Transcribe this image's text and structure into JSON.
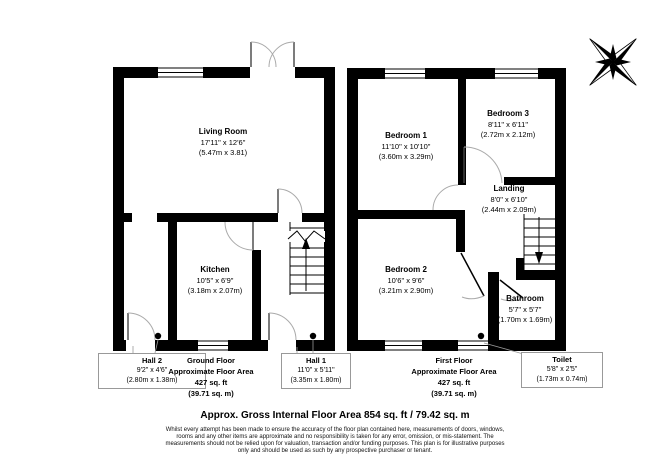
{
  "colors": {
    "wall": "#000000",
    "door_arc": "#aaaaaa",
    "door_leaf": "#444444",
    "label_box_border": "#999999",
    "text": "#000000"
  },
  "icons": {
    "compass": "compass-rose"
  },
  "ground_floor": {
    "title": "Ground Floor",
    "subtitle": "Approximate Floor Area",
    "area_ft": "427 sq. ft",
    "area_m": "(39.71 sq. m)",
    "rooms": {
      "living_room": {
        "name": "Living Room",
        "imperial": "17'11\" x 12'6\"",
        "metric": "(5.47m x 3.81)"
      },
      "kitchen": {
        "name": "Kitchen",
        "imperial": "10'5\" x 6'9\"",
        "metric": "(3.18m x 2.07m)"
      },
      "hall2": {
        "name": "Hall 2",
        "imperial": "9'2\" x 4'6\"",
        "metric": "(2.80m x 1.38m)"
      },
      "hall1": {
        "name": "Hall 1",
        "imperial": "11'0\" x 5'11\"",
        "metric": "(3.35m x 1.80m)"
      }
    }
  },
  "first_floor": {
    "title": "First Floor",
    "subtitle": "Approximate Floor Area",
    "area_ft": "427 sq. ft",
    "area_m": "(39.71 sq. m)",
    "rooms": {
      "bedroom1": {
        "name": "Bedroom 1",
        "imperial": "11'10\" x 10'10\"",
        "metric": "(3.60m x 3.29m)"
      },
      "bedroom2": {
        "name": "Bedroom 2",
        "imperial": "10'6\" x 9'6\"",
        "metric": "(3.21m x 2.90m)"
      },
      "bedroom3": {
        "name": "Bedroom 3",
        "imperial": "8'11\" x 6'11\"",
        "metric": "(2.72m x 2.12m)"
      },
      "landing": {
        "name": "Landing",
        "imperial": "8'0\" x 6'10\"",
        "metric": "(2.44m x 2.09m)"
      },
      "bathroom": {
        "name": "Bathroom",
        "imperial": "5'7\" x 5'7\"",
        "metric": "(1.70m x 1.69m)"
      },
      "toilet": {
        "name": "Toilet",
        "imperial": "5'8\" x 2'5\"",
        "metric": "(1.73m x 0.74m)"
      }
    }
  },
  "footer": {
    "headline": "Approx. Gross Internal Floor Area 854 sq. ft / 79.42 sq. m",
    "disclaimer_lines": [
      "Whilst every attempt has been made to ensure the accuracy of the floor plan contained here, measurements of doors, windows,",
      "rooms and any other items are approximate and no responsibility is taken for any error, omission, or mis-statement. The",
      "measurements should not be relied upon for valuation, transaction and/or funding purposes. This plan is for illustrative purposes",
      "only and should be used as such by any prospective purchaser or tenant."
    ]
  }
}
